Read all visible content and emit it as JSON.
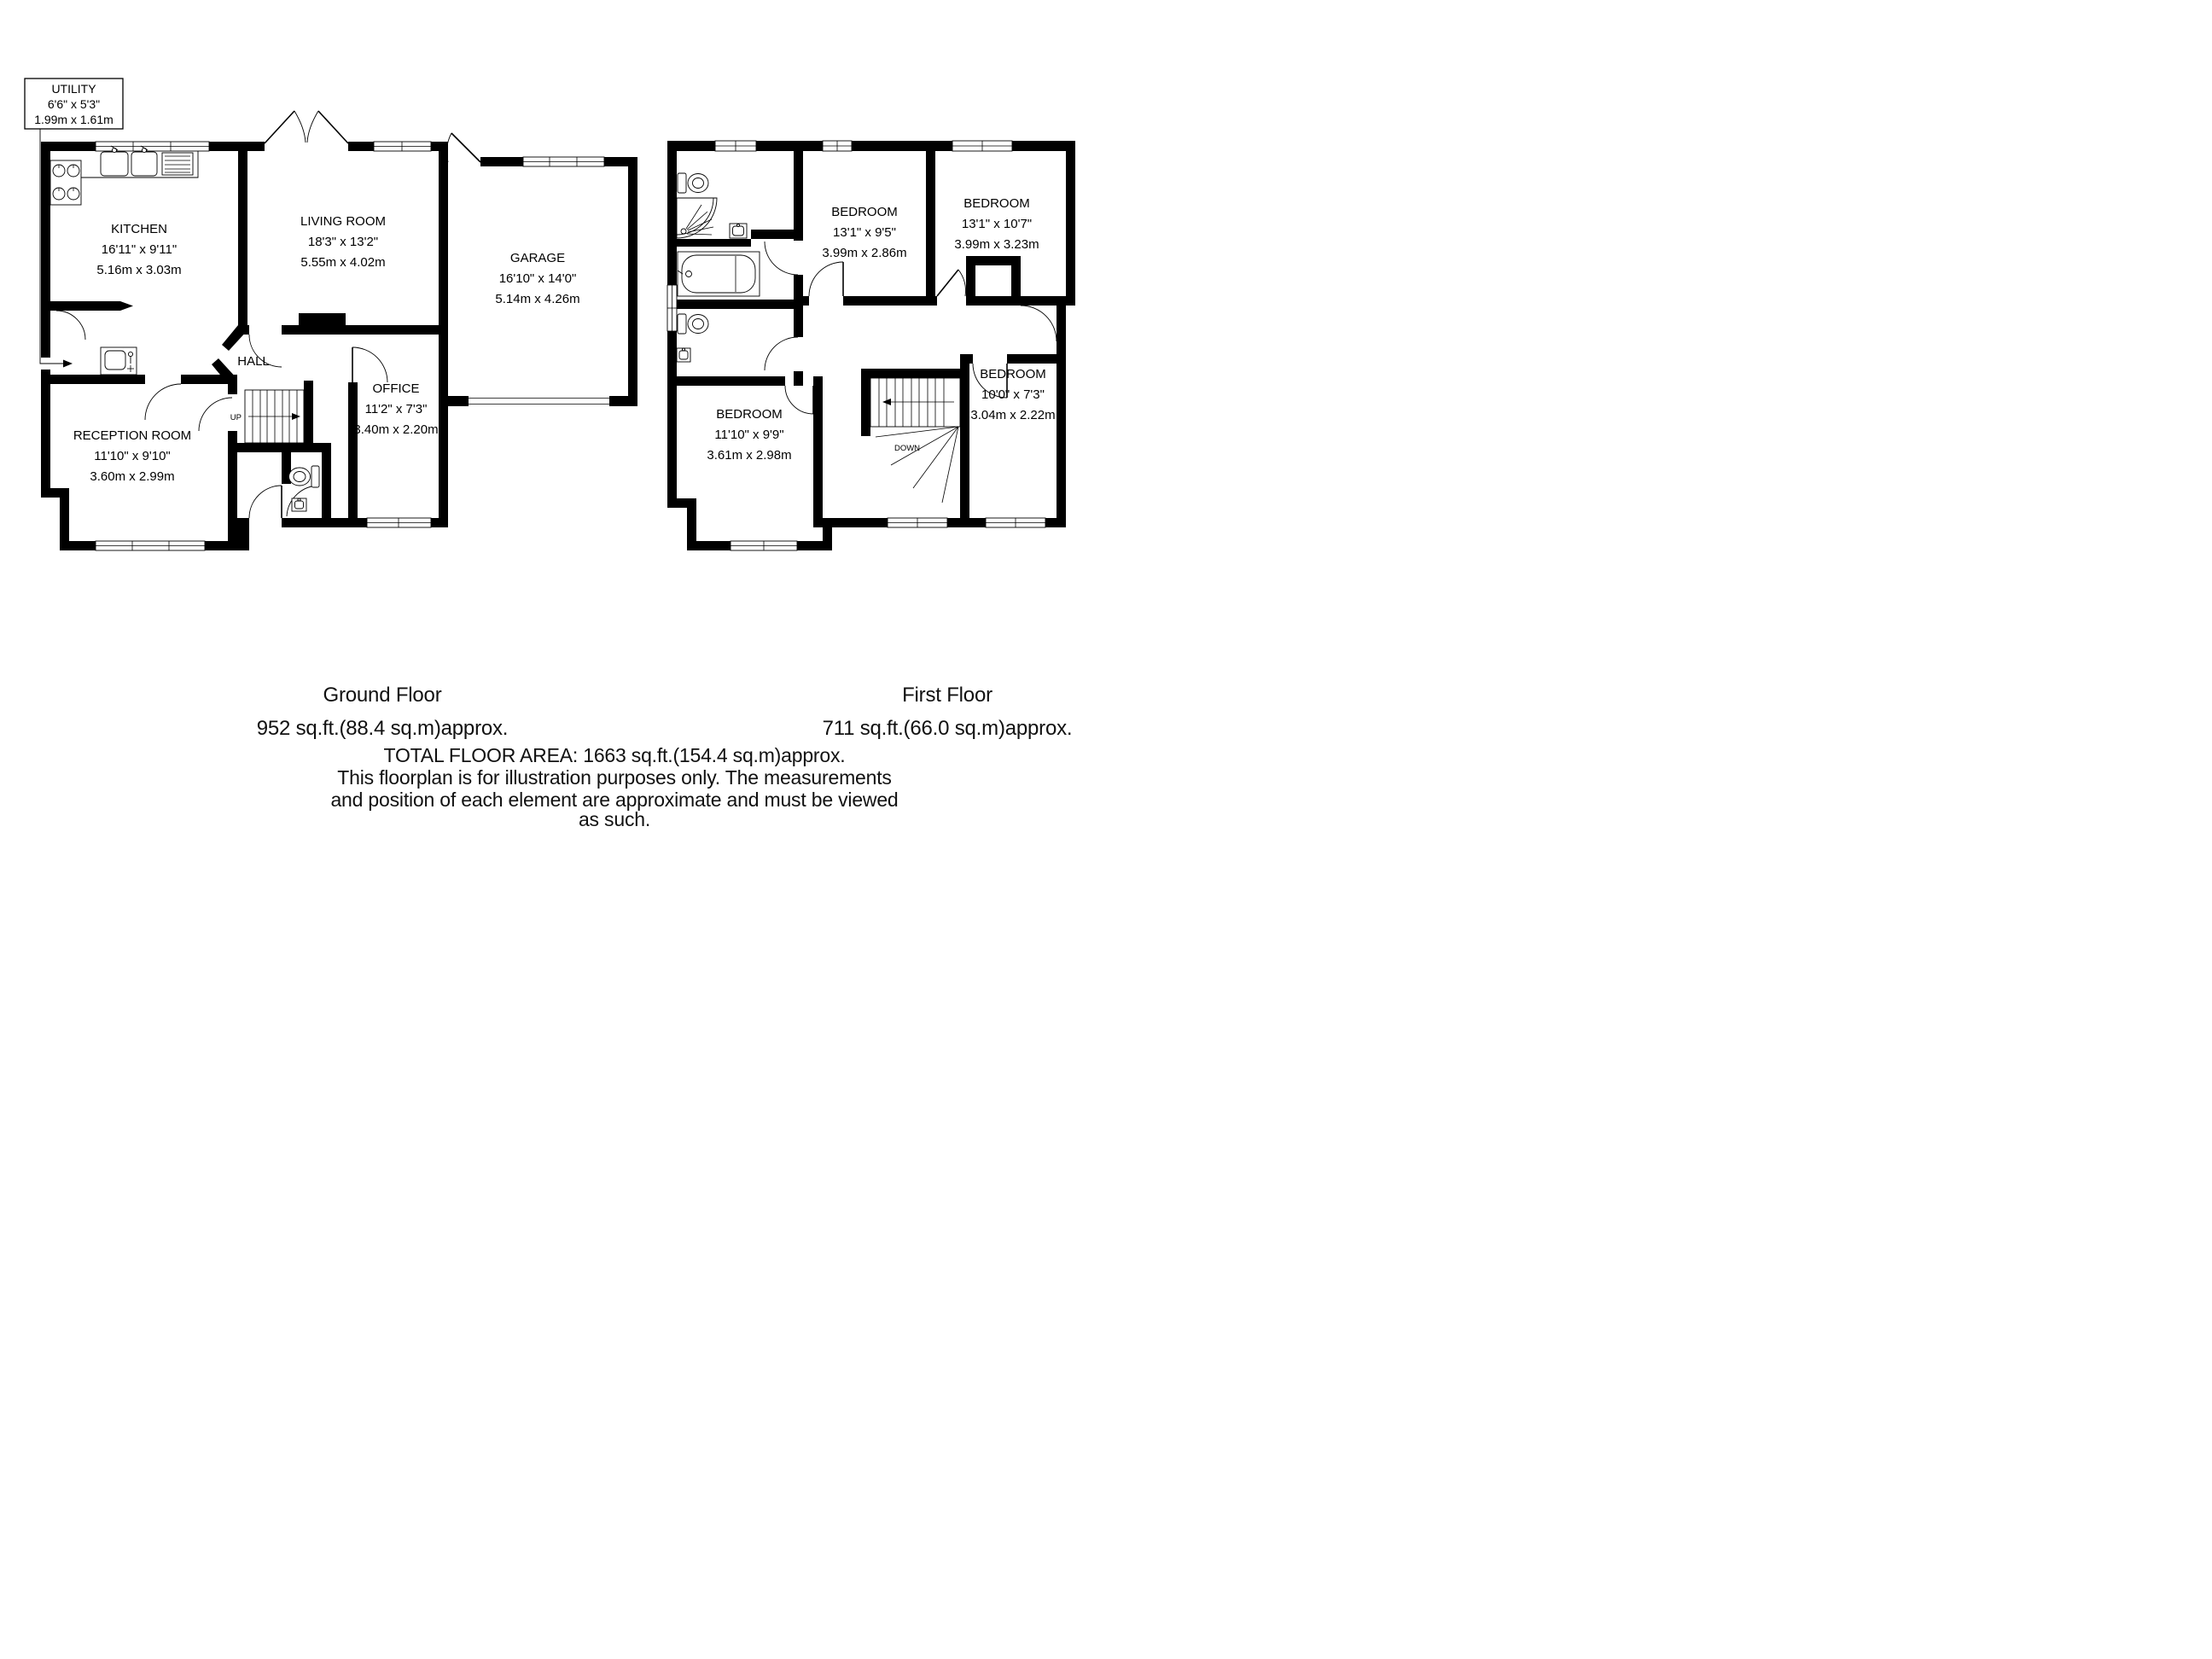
{
  "colors": {
    "ink": "#000000",
    "background": "#ffffff"
  },
  "callout": {
    "title": "UTILITY",
    "imperial": "6'6\" x 5'3\"",
    "metric": "1.99m x 1.61m"
  },
  "ground_floor": {
    "rooms": {
      "kitchen": {
        "name": "KITCHEN",
        "imperial": "16'11\" x 9'11\"",
        "metric": "5.16m x 3.03m"
      },
      "living_room": {
        "name": "LIVING ROOM",
        "imperial": "18'3\" x 13'2\"",
        "metric": "5.55m x 4.02m"
      },
      "garage": {
        "name": "GARAGE",
        "imperial": "16'10\" x 14'0\"",
        "metric": "5.14m x 4.26m"
      },
      "hall": {
        "name": "HALL"
      },
      "office": {
        "name": "OFFICE",
        "imperial": "11'2\" x 7'3\"",
        "metric": "3.40m x 2.20m"
      },
      "reception_room": {
        "name": "RECEPTION ROOM",
        "imperial": "11'10\" x 9'10\"",
        "metric": "3.60m x 2.99m"
      }
    },
    "stairs_label": "UP",
    "caption": {
      "title": "Ground Floor",
      "area": "952 sq.ft.(88.4 sq.m)approx."
    }
  },
  "first_floor": {
    "rooms": {
      "bedroom_1": {
        "name": "BEDROOM",
        "imperial": "13'1\" x 9'5\"",
        "metric": "3.99m x 2.86m"
      },
      "bedroom_2": {
        "name": "BEDROOM",
        "imperial": "13'1\" x 10'7\"",
        "metric": "3.99m x 3.23m"
      },
      "bedroom_3": {
        "name": "BEDROOM",
        "imperial": "11'10\" x 9'9\"",
        "metric": "3.61m x 2.98m"
      },
      "bedroom_4": {
        "name": "BEDROOM",
        "imperial": "10'0\" x 7'3\"",
        "metric": "3.04m x 2.22m"
      }
    },
    "stairs_label": "DOWN",
    "caption": {
      "title": "First Floor",
      "area": "711 sq.ft.(66.0 sq.m)approx."
    }
  },
  "footer": {
    "lines": [
      "TOTAL FLOOR AREA: 1663 sq.ft.(154.4 sq.m)approx.",
      "This floorplan is for illustration purposes only. The measurements",
      "and position of each element are approximate and must be viewed",
      "as such."
    ]
  }
}
